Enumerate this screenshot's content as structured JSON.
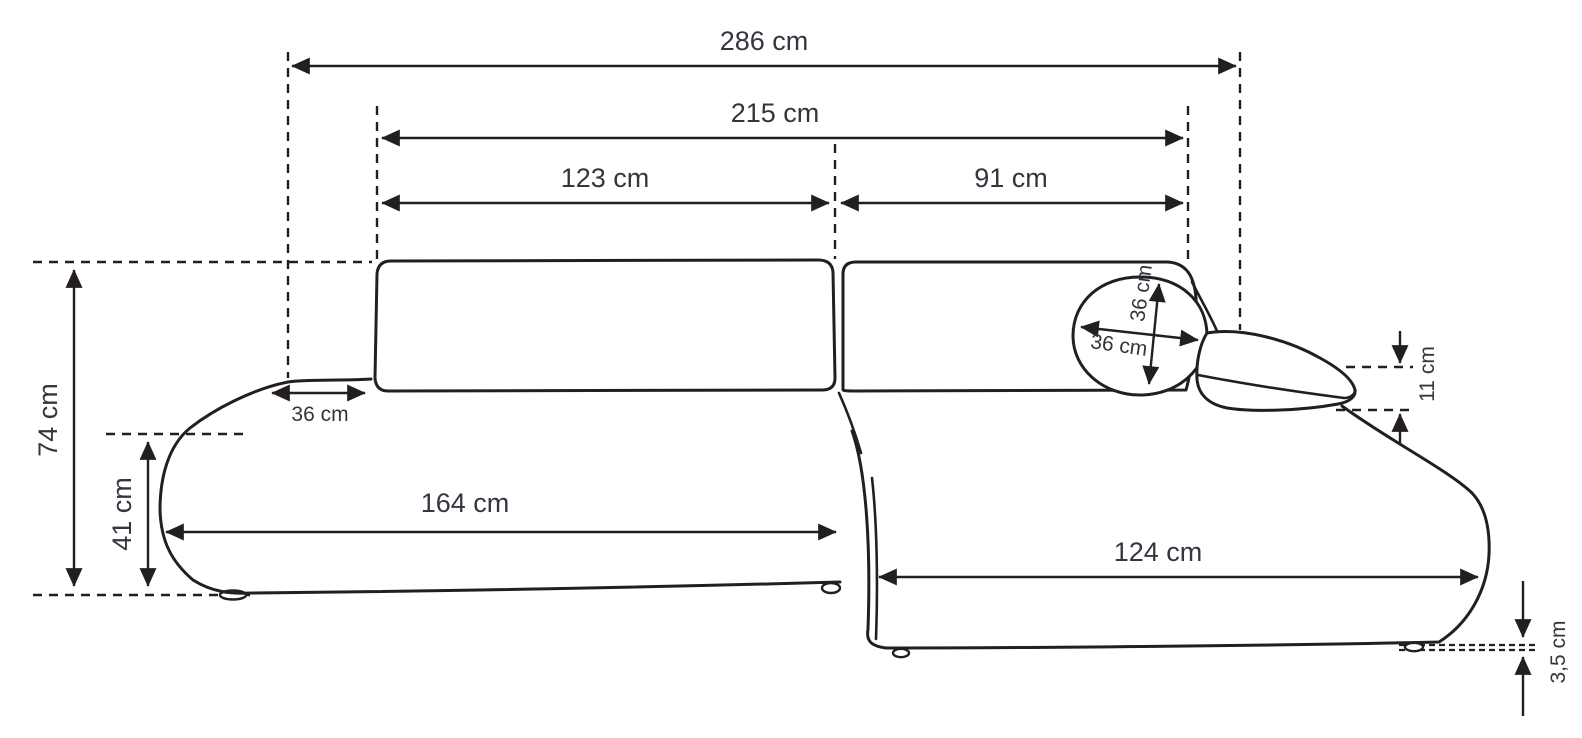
{
  "colors": {
    "line": "#231f20",
    "text": "#35353f",
    "background": "#ffffff"
  },
  "labels": {
    "overall_width": "286 cm",
    "backrest_width": "215 cm",
    "left_backrest_width": "123 cm",
    "right_backrest_width": "91 cm",
    "overall_height": "74 cm",
    "seat_height": "41 cm",
    "armrest_width": "36 cm",
    "headrest_pillow_height": "36 cm",
    "headrest_pillow_width": "36 cm",
    "seat_length": "164 cm",
    "chaise_length": "124 cm",
    "side_pillow_thickness": "11 cm",
    "leg_height": "3,5 cm"
  }
}
